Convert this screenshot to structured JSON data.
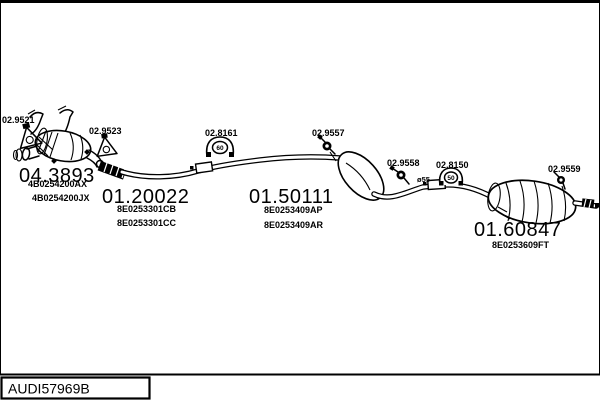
{
  "colors": {
    "ink": "#000000",
    "background": "#ffffff"
  },
  "diagram": {
    "drawing_id": "AUDI57969B",
    "parts": [
      {
        "code": "04.3893",
        "part_numbers": [
          "4B0254200AX",
          "4B0254200JX"
        ]
      },
      {
        "code": "01.20022",
        "part_numbers": [
          "8E0253301CB",
          "8E0253301CC"
        ]
      },
      {
        "code": "01.50111",
        "part_numbers": [
          "8E0253409AP",
          "8E0253409AR"
        ]
      },
      {
        "code": "01.60847",
        "part_numbers": [
          "8E0253609FT"
        ]
      }
    ],
    "fittings": [
      {
        "code": "02.9521",
        "type": "triangle-hanger"
      },
      {
        "code": "02.9523",
        "type": "triangle-hanger"
      },
      {
        "code": "02.8161",
        "type": "clamp",
        "size": "60"
      },
      {
        "code": "02.9557",
        "type": "rubber-hanger"
      },
      {
        "code": "02.9558",
        "type": "rubber-hanger"
      },
      {
        "code": "02.8150",
        "type": "clamp",
        "size": "50"
      },
      {
        "code": "02.9559",
        "type": "rubber-hanger"
      }
    ],
    "pipe_diameter": "ø55"
  }
}
